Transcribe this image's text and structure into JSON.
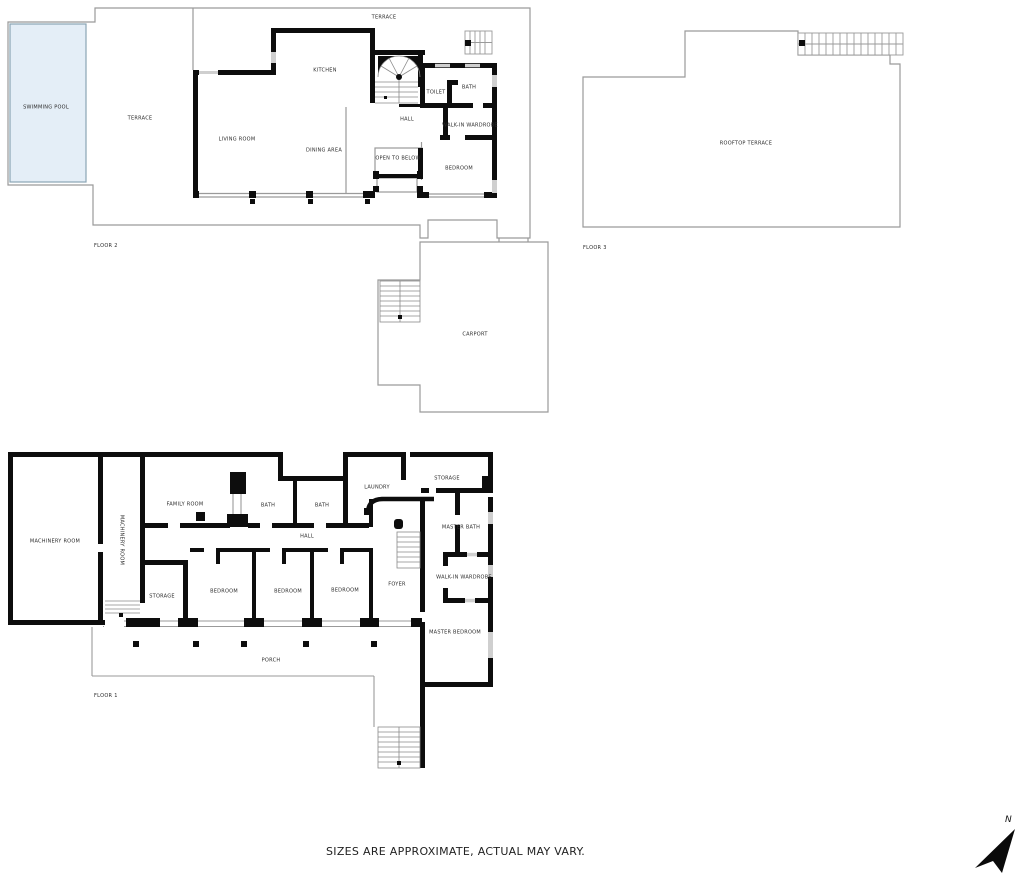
{
  "footer": {
    "note": "SIZES ARE APPROXIMATE, ACTUAL MAY VARY."
  },
  "compass": {
    "label": "N"
  },
  "colors": {
    "wall": "#0d0d0d",
    "outline": "#9a9a9a",
    "window": "#cfcfcf",
    "pool_fill": "#e4eef7",
    "pool_border": "#8aa5b5"
  },
  "floor2": {
    "caption": "FLOOR 2",
    "carport": "CARPORT",
    "rooms": {
      "swimming_pool": "SWIMMING POOL",
      "terrace": "TERRACE",
      "terrace_top": "TERRACE",
      "kitchen": "KITCHEN",
      "living_room": "LIVING ROOM",
      "dining_area": "DINING AREA",
      "hall": "HALL",
      "open_to_below": "OPEN TO BELOW",
      "toilet": "TOILET",
      "bath": "BATH",
      "walk_in_wardrobe": "WALK-IN WARDROBE",
      "bedroom": "BEDROOM"
    }
  },
  "floor3": {
    "caption": "FLOOR 3",
    "rooms": {
      "rooftop_terrace": "ROOFTOP TERRACE"
    }
  },
  "floor1": {
    "caption": "FLOOR 1",
    "rooms": {
      "machinery_room": "MACHINERY ROOM",
      "machinery_room_vertical": "MACHINERY ROOM",
      "family_room": "FAMILY ROOM",
      "bath_1": "BATH",
      "bath_2": "BATH",
      "laundry": "LAUNDRY",
      "storage_top": "STORAGE",
      "master_bath": "MASTER BATH",
      "hall": "HALL",
      "storage_bottom": "STORAGE",
      "bedroom_1": "BEDROOM",
      "bedroom_2": "BEDROOM",
      "bedroom_3": "BEDROOM",
      "foyer": "FOYER",
      "walk_in_wardrobe": "WALK-IN WARDROBE",
      "master_bedroom": "MASTER BEDROOM",
      "porch": "PORCH"
    }
  }
}
